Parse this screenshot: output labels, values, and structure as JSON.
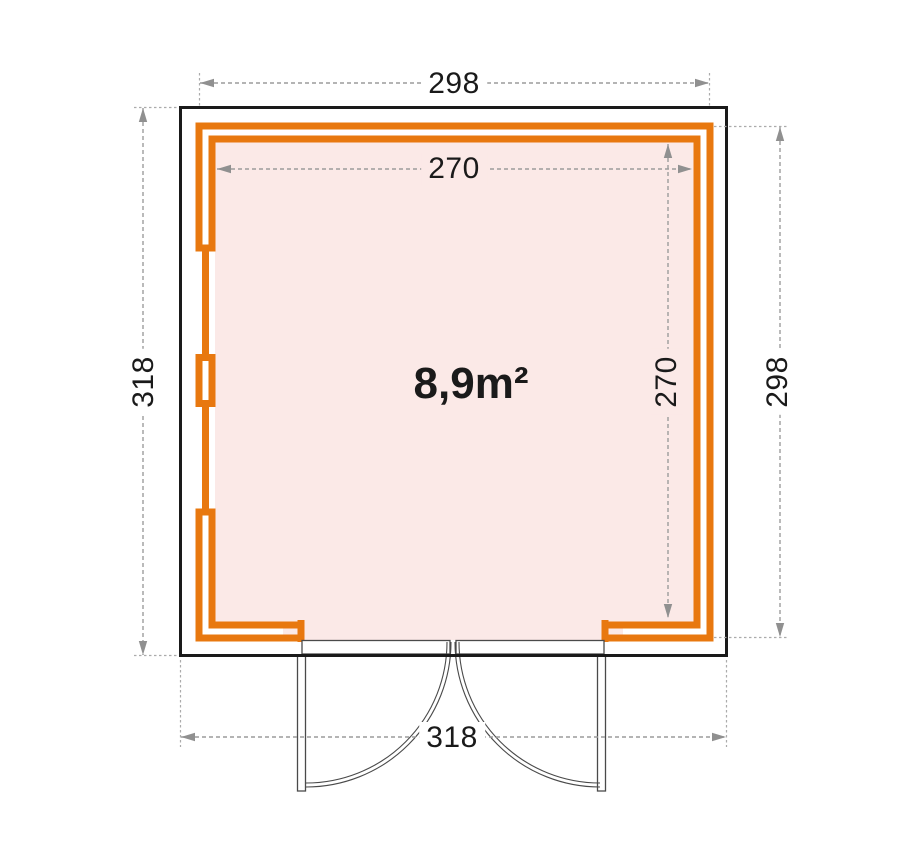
{
  "plan": {
    "area_label": "8,9m²",
    "dimensions": {
      "outer_width_top": "298",
      "inner_width_top": "270",
      "base_depth_left": "318",
      "inner_depth_right": "270",
      "outer_depth_right": "298",
      "base_width_bottom": "318"
    },
    "colors": {
      "wall": "#E8780F",
      "floor": "#FBE9E7",
      "base_outline": "#1A1A1A",
      "dimension_line": "#9C9C9C",
      "arrow": "#909090",
      "door": "#4A4A4A"
    }
  }
}
